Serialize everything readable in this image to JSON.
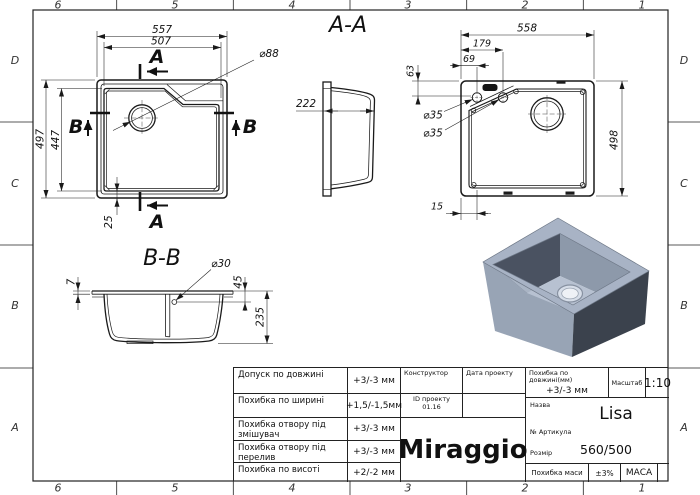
{
  "border": {
    "cols": [
      "6",
      "5",
      "4",
      "3",
      "2",
      "1"
    ],
    "rows": [
      "D",
      "C",
      "B",
      "A"
    ]
  },
  "plan_view": {
    "dim_width_outer": "557",
    "dim_width_inner": "507",
    "dim_height_outer": "497",
    "dim_height_inner": "447",
    "dim_offset": "25",
    "dia_drain": "⌀88",
    "section_a": "A",
    "section_b": "B"
  },
  "section_aa": {
    "title": "A-A",
    "dim_depth": "222"
  },
  "bottom_view": {
    "dim_width": "558",
    "dim_tap2": "179",
    "dim_tap1": "69",
    "dim_edge": "63",
    "dia_tap1": "⌀35",
    "dia_tap2": "⌀35",
    "dim_height": "498",
    "dim_wall": "15"
  },
  "section_bb": {
    "title": "B-B",
    "dim_rim": "7",
    "dia_overflow": "⌀30",
    "dim_overflow_depth": "45",
    "dim_bowl_depth": "235"
  },
  "title_block": {
    "tolerances": [
      {
        "label": "Допуск по довжині",
        "value": "+3/-3 мм"
      },
      {
        "label": "Похибка по ширині",
        "value": "+1,5/-1,5мм"
      },
      {
        "label": "Похибка отвору під змішувач",
        "value": "+3/-3 мм"
      },
      {
        "label": "Похибка отвору під перелив",
        "value": "+3/-3 мм"
      },
      {
        "label": "Похибка по висоті",
        "value": "+2/-2 мм"
      }
    ],
    "constructor_label": "Конструктор",
    "date_label": "Дата проекту",
    "project_id_label": "ID проекту",
    "project_id_value": "01.16",
    "logo": "Miraggio",
    "length_tol_label": "Похибка по довжині(мм)",
    "length_tol_value": "+3/-3 мм",
    "scale_label": "Масштаб",
    "scale_value": "1:10",
    "name_label": "Назва",
    "name_value": "Lisa",
    "article_label": "№ Артикула",
    "size_label": "Розмір",
    "size_value": "560/500",
    "mass_tol_label": "Похибка маси",
    "mass_tol_value": "±3%",
    "mass_label": "МАСА"
  },
  "colors": {
    "sink_rim": "#a8b3c5",
    "sink_left": "#98a4b5",
    "sink_right": "#3b424d",
    "wall_dark": "#4a5261",
    "wall_mid": "#8d99aa",
    "wall_front_right": "#b0bbca",
    "wall_front_left": "#a9b4c4",
    "bowl_bottom": "#b7c1d1",
    "drain_ring": "#d6dde8",
    "drain_hole": "#eef1f6"
  }
}
